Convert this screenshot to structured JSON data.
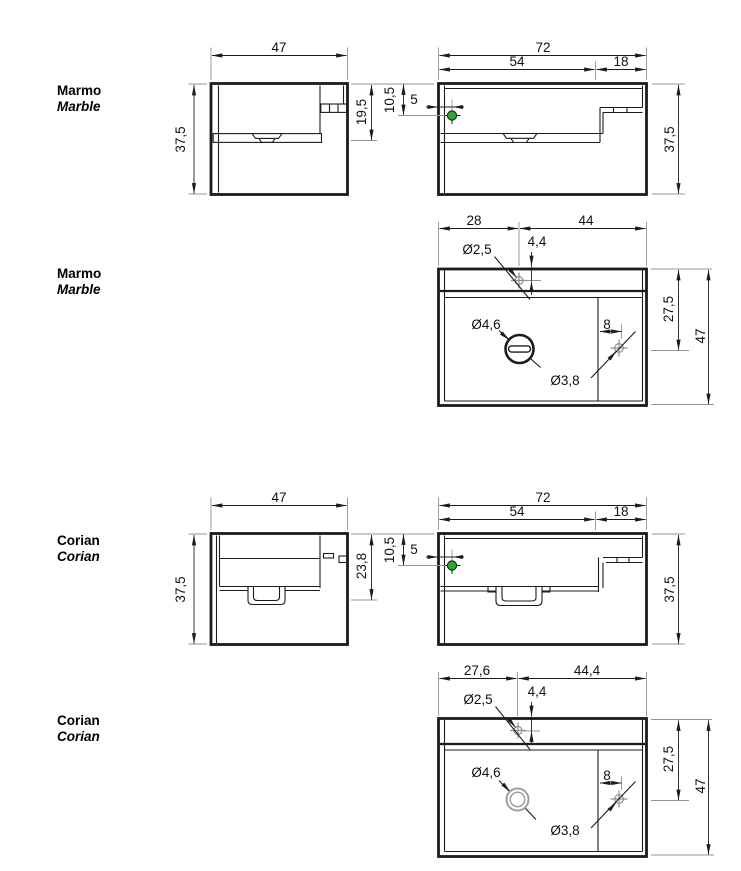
{
  "page": {
    "background": "#ffffff"
  },
  "colors": {
    "line": "#1c1c1c",
    "extension_line": "#949494",
    "symbol_gray": "#8f8f8f",
    "faucet_green": "#35a035",
    "faucet_green_edge": "#0d3b10"
  },
  "labels": {
    "row1": {
      "primary": "Marmo",
      "secondary": "Marble"
    },
    "row2": {
      "primary": "Marmo",
      "secondary": "Marble"
    },
    "row3": {
      "primary": "Corian",
      "secondary": "Corian"
    },
    "row4": {
      "primary": "Corian",
      "secondary": "Corian"
    }
  },
  "views": {
    "marmo_side": {
      "width": "47",
      "height": "37,5",
      "basin_depth": "19,5"
    },
    "marmo_front": {
      "width": "72",
      "basin_width": "54",
      "ledge_width": "18",
      "hole_from_top": "10,5",
      "hole_from_edge": "5",
      "height": "37,5"
    },
    "marmo_plan": {
      "hole_from_left": "28",
      "hole_to_right": "44",
      "hole_from_back": "4,4",
      "faucet_hole_dia": "Ø2,5",
      "drain_dia": "Ø4,6",
      "overflow_dia": "Ø3,8",
      "overflow_offset": "8",
      "overflow_from_back": "27,5",
      "depth": "47"
    },
    "corian_side": {
      "width": "47",
      "height": "37,5",
      "basin_depth": "23,8"
    },
    "corian_front": {
      "width": "72",
      "basin_width": "54",
      "ledge_width": "18",
      "hole_from_top": "10,5",
      "hole_from_edge": "5",
      "height": "37,5"
    },
    "corian_plan": {
      "hole_from_left": "27,6",
      "hole_to_right": "44,4",
      "hole_from_back": "4,4",
      "faucet_hole_dia": "Ø2,5",
      "drain_dia": "Ø4,6",
      "overflow_dia": "Ø3,8",
      "overflow_offset": "8",
      "overflow_from_back": "27,5",
      "depth": "47"
    }
  }
}
